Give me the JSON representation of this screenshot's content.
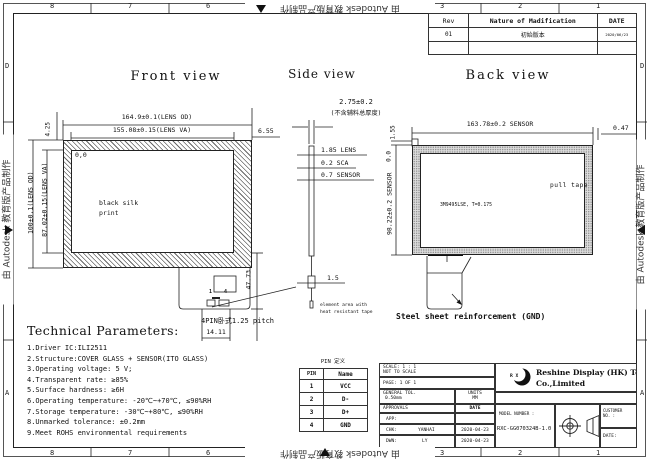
{
  "sheet": {
    "watermark": "由 Autodesk 教育版产品制作",
    "cols": [
      "8",
      "7",
      "6",
      "5",
      "4",
      "3",
      "2",
      "1"
    ],
    "rows": [
      "D",
      "C",
      "B",
      "A"
    ]
  },
  "rev": {
    "headers": [
      "Rev",
      "Nature of Madification",
      "DATE"
    ],
    "row": {
      "rev": "01",
      "desc": "初始版本",
      "date": "2020/06/23"
    }
  },
  "front": {
    "title": "Front view",
    "od_w": "164.9±0.1(LENS OD)",
    "va_w": "155.08±0.15(LENS VA)",
    "od_h": "100±0.1(LENS OD)",
    "va_h": "87.02±0.15(LENS VA)",
    "top_left": "4.25",
    "top_right": "6.55",
    "origin": "0,0",
    "silk1": "black silk",
    "silk2": "print",
    "tail_len": "47.73",
    "connector": "4PIN卧式1.25 pitch",
    "connector_w": "14.11",
    "pin_first": "1",
    "pin_last": "4",
    "note1": "element area with",
    "note2": "heat resistant tape"
  },
  "side": {
    "title": "Side view",
    "total": "2.75±0.2",
    "total_note": "(不含辅料总厚度)",
    "lens": "1.85 LENS",
    "sca": "0.2 SCA",
    "sensor": "0.7 SENSOR",
    "fpc": "1.5"
  },
  "back": {
    "title": "Back view",
    "sensor_w": "163.78±0.2 SENSOR",
    "right_off": "0.47",
    "top_off": "1.55",
    "sensor_h": "98.22±0.2 SENSOR",
    "origin": "0.0",
    "pull_tape": "pull tape",
    "tape": "3M9495LSE, T=0.175",
    "steel": "Steel sheet reinforcement (GND)"
  },
  "tech": {
    "title": "Technical Parameters:",
    "items": [
      "1.Driver IC:ILI2511",
      "2.Structure:COVER GLASS + SENSOR(ITO GLASS)",
      "3.Operating voltage: 5 V;",
      "4.Transparent rate: ≥85%",
      "5.Surface hardness: ≥6H",
      "6.Operating temperature: -20℃~+70℃, ≤90%RH",
      "7.Storage temperature: -30℃~+80℃, ≤90%RH",
      "8.Unmarked tolerance: ±0.2mm",
      "9.Meet ROHS environmental requirements"
    ]
  },
  "pins": {
    "title": "PIN 定义",
    "headers": [
      "PIN",
      "Name"
    ],
    "rows": [
      {
        "pin": "1",
        "name": "VCC"
      },
      {
        "pin": "2",
        "name": "D-"
      },
      {
        "pin": "3",
        "name": "D+"
      },
      {
        "pin": "4",
        "name": "GND"
      }
    ]
  },
  "tb": {
    "scale1": "SCALE: 1 : 1",
    "scale2": "NOT TO SCALE",
    "page": "PAGE: 1 OF 1",
    "tol_label": "GENERAL TOL.",
    "tol_value": "0.50mm",
    "units_label": "UNITS",
    "units_value": "MM",
    "approvals": "APPROVALS",
    "date_hdr": "DATE",
    "app": "APP:",
    "chk": "CHK:",
    "chk_name": "YANHAI",
    "chk_date": "2020-04-23",
    "dwn": "DWN:",
    "dwn_name": "LY",
    "dwn_date": "2020-04-23",
    "logo_text": "R X",
    "company1": "Reshine Display (HK) Technology",
    "company2": "Co.,Limited",
    "model_label": "MODEL NUMBER :",
    "model_value": "RXC-GG070324B-1.0",
    "customer1": "CUSTOMER",
    "customer2": "NO. :",
    "date_label": "DATE:"
  }
}
